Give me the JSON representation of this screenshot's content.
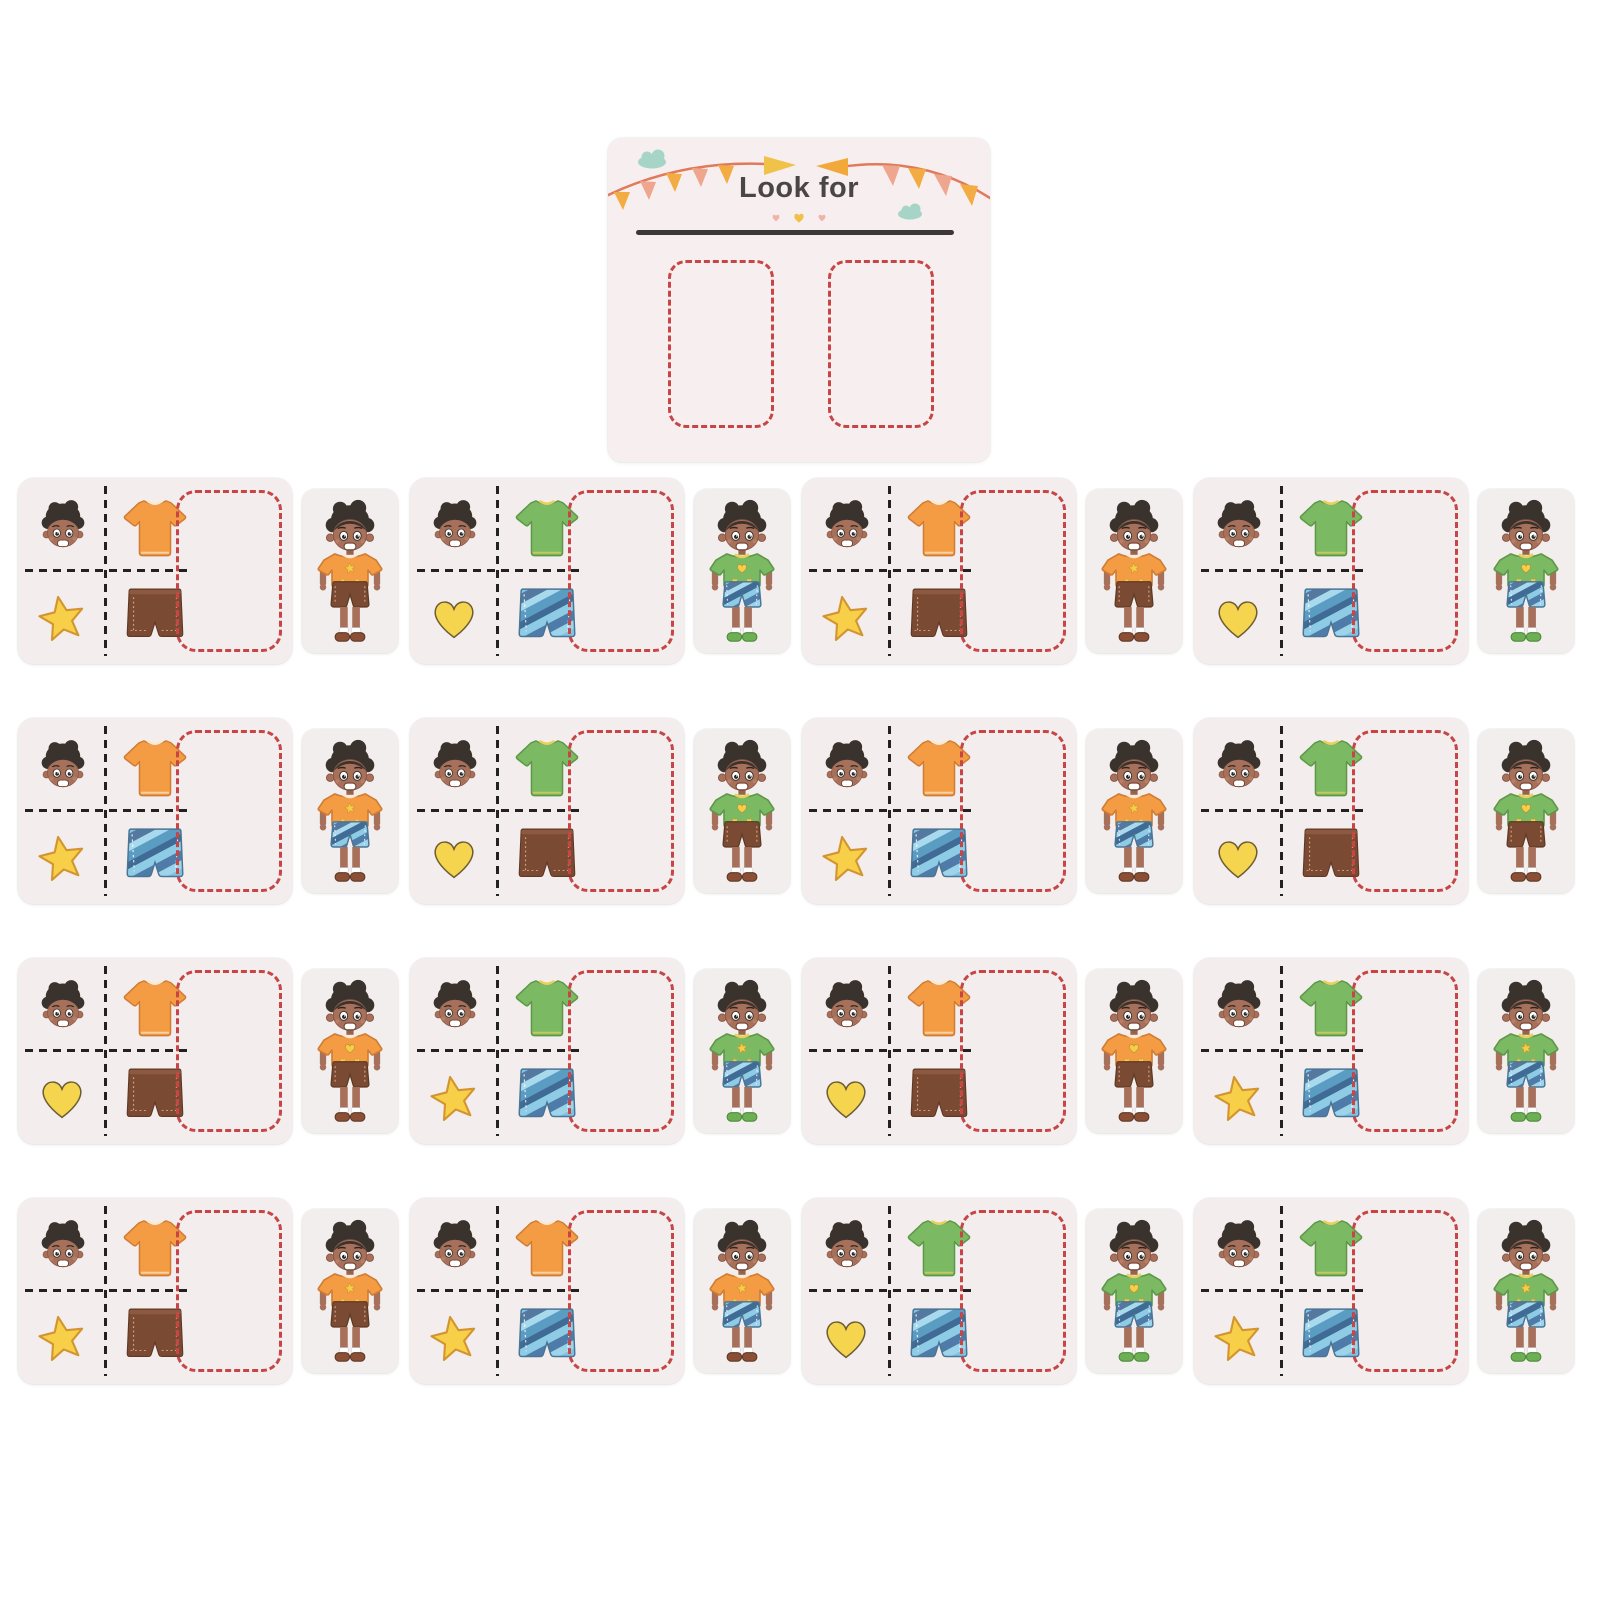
{
  "board": {
    "title": "Look for",
    "slot_count": 2,
    "decorations": {
      "bunting_left_flags": 5,
      "bunting_right_flags": 4,
      "end_pennants": 2,
      "clouds": 2,
      "mini_hearts": 3
    }
  },
  "palette": {
    "page_bg": "#ffffff",
    "card_bg": "#f3eded",
    "board_bg": "#f7efef",
    "title_text": "#4b4646",
    "dash_red": "#c74545",
    "dash_black": "#222222",
    "shirt_orange": "#f49c43",
    "shirt_green": "#7cb963",
    "shorts_brown": "#7b4a33",
    "shorts_blue": "#68b2d8",
    "symbol_yellow": "#f8cf49",
    "skin": "#a7705a",
    "hair": "#3a332d",
    "shoe_brown": "#8a4f35",
    "shoe_green": "#6db054",
    "bunting_orange": "#f3ac43",
    "bunting_salmon": "#efa68e",
    "pennant_yellow": "#f1c24a",
    "cloud_teal": "#a6d4c7",
    "deco_heart_pink": "#f0b2a9",
    "deco_heart_yellow": "#f1c04b"
  },
  "cards": [
    {
      "row": 1,
      "col": 1,
      "shirt": "orange",
      "symbol": "star",
      "shorts": "brown",
      "shoe": "brown"
    },
    {
      "row": 1,
      "col": 2,
      "shirt": "green",
      "symbol": "heart",
      "shorts": "blue",
      "shoe": "green"
    },
    {
      "row": 1,
      "col": 3,
      "shirt": "orange",
      "symbol": "star",
      "shorts": "brown",
      "shoe": "brown"
    },
    {
      "row": 1,
      "col": 4,
      "shirt": "green",
      "symbol": "heart",
      "shorts": "blue",
      "shoe": "green"
    },
    {
      "row": 2,
      "col": 1,
      "shirt": "orange",
      "symbol": "star",
      "shorts": "blue",
      "shoe": "brown"
    },
    {
      "row": 2,
      "col": 2,
      "shirt": "green",
      "symbol": "heart",
      "shorts": "brown",
      "shoe": "brown"
    },
    {
      "row": 2,
      "col": 3,
      "shirt": "orange",
      "symbol": "star",
      "shorts": "blue",
      "shoe": "brown"
    },
    {
      "row": 2,
      "col": 4,
      "shirt": "green",
      "symbol": "heart",
      "shorts": "brown",
      "shoe": "brown"
    },
    {
      "row": 3,
      "col": 1,
      "shirt": "orange",
      "symbol": "heart",
      "shorts": "brown",
      "shoe": "brown"
    },
    {
      "row": 3,
      "col": 2,
      "shirt": "green",
      "symbol": "star",
      "shorts": "blue",
      "shoe": "green"
    },
    {
      "row": 3,
      "col": 3,
      "shirt": "orange",
      "symbol": "heart",
      "shorts": "brown",
      "shoe": "brown"
    },
    {
      "row": 3,
      "col": 4,
      "shirt": "green",
      "symbol": "star",
      "shorts": "blue",
      "shoe": "green"
    },
    {
      "row": 4,
      "col": 1,
      "shirt": "orange",
      "symbol": "star",
      "shorts": "brown",
      "shoe": "brown"
    },
    {
      "row": 4,
      "col": 2,
      "shirt": "orange",
      "symbol": "star",
      "shorts": "blue",
      "shoe": "brown"
    },
    {
      "row": 4,
      "col": 3,
      "shirt": "green",
      "symbol": "heart",
      "shorts": "blue",
      "shoe": "green"
    },
    {
      "row": 4,
      "col": 4,
      "shirt": "green",
      "symbol": "star",
      "shorts": "blue",
      "shoe": "green"
    }
  ]
}
